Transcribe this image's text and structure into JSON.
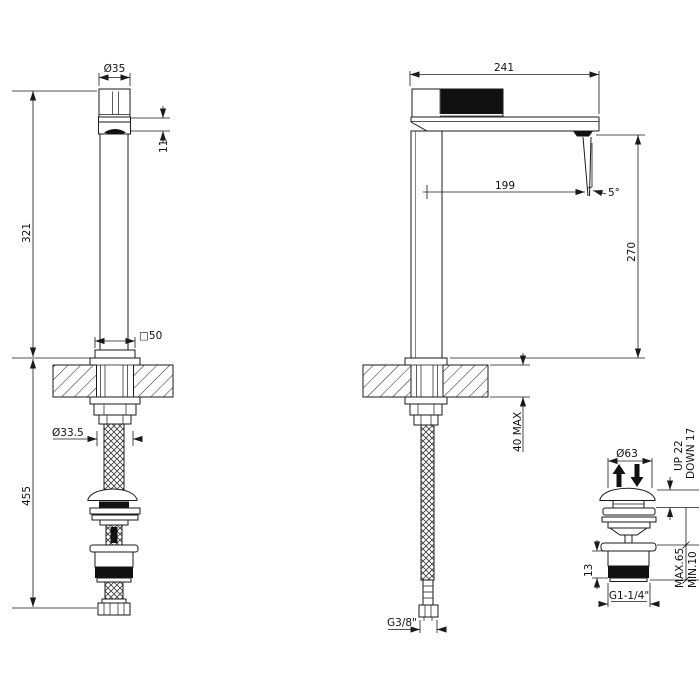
{
  "meta": {
    "type": "technical-drawing",
    "subject": "tall single-hole basin mixer with flexible hose and clic-clac pop-up waste",
    "colors": {
      "line": "#1a1a1a",
      "fill_black": "#111111",
      "background": "#ffffff"
    }
  },
  "dims": {
    "front": {
      "handle_dia": "Ø35",
      "spout_h": "11",
      "height_above_deck": "321",
      "length_below_deck": "455",
      "shank_dia": "Ø33.5",
      "base_sq": "□50"
    },
    "side": {
      "reach": "241",
      "stream_offset": "199",
      "stream_angle": "5°",
      "outlet_height": "270",
      "deck_thickness": "40 MAX",
      "inlet_thread": "G3/8\""
    },
    "drain": {
      "cap_dia": "Ø63",
      "up_travel": "UP 22",
      "down_travel": "DOWN 17",
      "max_deck": "MAX.65",
      "min_deck": "MIN.10",
      "thread_h": "13",
      "waste_thread": "G1-1/4\""
    }
  }
}
